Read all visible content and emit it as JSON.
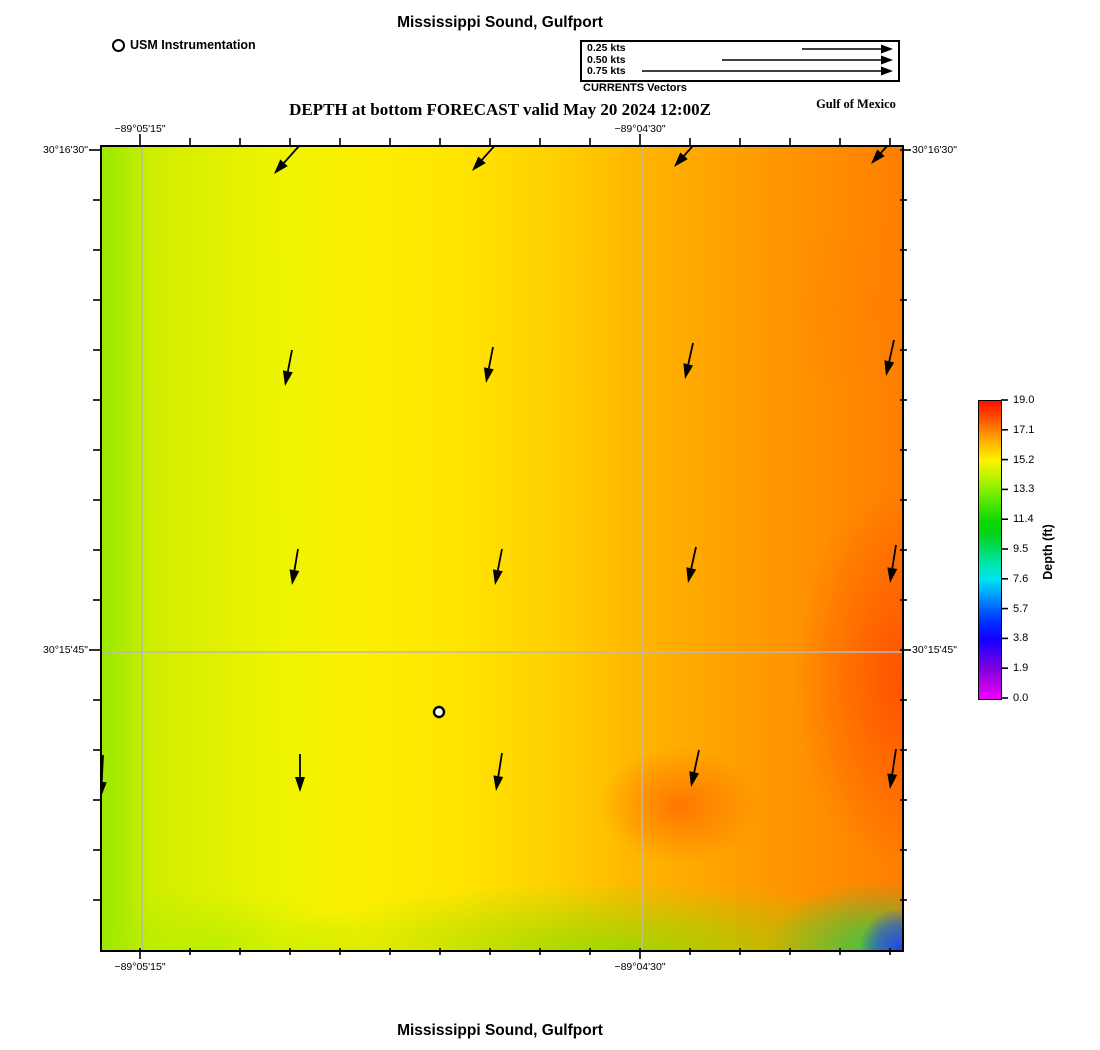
{
  "header": {
    "title": "Mississippi Sound, Gulfport",
    "instrumentation_label": "USM Instrumentation",
    "vector_legend": {
      "entries": [
        {
          "label": "0.25 kts",
          "x1": 220,
          "y": 7
        },
        {
          "label": "0.50 kts",
          "x1": 140,
          "y": 18
        },
        {
          "label": "0.75 kts",
          "x1": 60,
          "y": 29
        }
      ],
      "tip_x": 311,
      "caption": "CURRENTS Vectors"
    },
    "subtitle": "DEPTH at bottom FORECAST valid May 20 2024 12:00Z",
    "region_label": "Gulf of Mexico"
  },
  "map": {
    "axis": {
      "top": [
        {
          "text": "−89°05'15\"",
          "x": 140
        },
        {
          "text": "−89°04'30\"",
          "x": 640
        }
      ],
      "bottom": [
        {
          "text": "−89°05'15\"",
          "x": 140
        },
        {
          "text": "−89°04'30\"",
          "x": 640
        }
      ],
      "left": [
        {
          "text": "30°16'30\"",
          "y": 150
        },
        {
          "text": "30°15'45\"",
          "y": 650
        }
      ],
      "right": [
        {
          "text": "30°16'30\"",
          "y": 150
        },
        {
          "text": "30°15'45\"",
          "y": 650
        }
      ]
    },
    "gridlines": {
      "vertical_x": [
        40,
        540
      ],
      "horizontal_y": [
        505
      ]
    },
    "station_marker": {
      "x": 337,
      "y": 565
    },
    "vectors": [
      {
        "x1": 206,
        "y1": -11,
        "x2": 172,
        "y2": 27
      },
      {
        "x1": 404,
        "y1": -14,
        "x2": 370,
        "y2": 24
      },
      {
        "x1": 606,
        "y1": -18,
        "x2": 572,
        "y2": 20
      },
      {
        "x1": 803,
        "y1": -21,
        "x2": 769,
        "y2": 17
      },
      {
        "x1": 190,
        "y1": 203,
        "x2": 183,
        "y2": 239
      },
      {
        "x1": 391,
        "y1": 200,
        "x2": 384,
        "y2": 236
      },
      {
        "x1": 591,
        "y1": 196,
        "x2": 583,
        "y2": 232
      },
      {
        "x1": 792,
        "y1": 193,
        "x2": 784,
        "y2": 229
      },
      {
        "x1": 196,
        "y1": 402,
        "x2": 190,
        "y2": 438
      },
      {
        "x1": 400,
        "y1": 402,
        "x2": 393,
        "y2": 438
      },
      {
        "x1": 594,
        "y1": 400,
        "x2": 586,
        "y2": 436
      },
      {
        "x1": 794,
        "y1": 398,
        "x2": 788,
        "y2": 436
      },
      {
        "x1": 198,
        "y1": 607,
        "x2": 198,
        "y2": 645
      },
      {
        "x1": 400,
        "y1": 606,
        "x2": 394,
        "y2": 644
      },
      {
        "x1": 597,
        "y1": 603,
        "x2": 589,
        "y2": 640
      },
      {
        "x1": 794,
        "y1": 602,
        "x2": 788,
        "y2": 642
      },
      {
        "x1": 1,
        "y1": 608,
        "x2": -1,
        "y2": 650
      }
    ]
  },
  "colorbar": {
    "title": "Depth (ft)",
    "ticks": [
      "19.0",
      "17.1",
      "15.2",
      "13.3",
      "11.4",
      "9.5",
      "7.6",
      "5.7",
      "3.8",
      "1.9",
      "0.0"
    ]
  },
  "footer": {
    "title": "Mississippi Sound, Gulfport"
  },
  "colors": {
    "vector": "#000000",
    "gridline": "#b8b8b8",
    "map_border": "#000000"
  },
  "chart_data": {
    "type": "heatmap",
    "title": "Mississippi Sound, Gulfport",
    "subtitle": "DEPTH at bottom FORECAST valid May 20 2024 12:00Z",
    "variable": "Depth (ft)",
    "colorbar": {
      "min": 0.0,
      "max": 19.0,
      "ticks": [
        19.0,
        17.1,
        15.2,
        13.3,
        11.4,
        9.5,
        7.6,
        5.7,
        3.8,
        1.9,
        0.0
      ],
      "colormap": "rainbow: magenta(0) → blue → cyan → green → yellow → orange → red(19)"
    },
    "x_axis": {
      "type": "longitude",
      "tick_labels": [
        "−89°05'15\"",
        "−89°04'30\""
      ],
      "grid": true
    },
    "y_axis": {
      "type": "latitude",
      "tick_labels": [
        "30°16'30\"",
        "30°15'45\""
      ],
      "grid": true
    },
    "depth_grid_ft_estimated": {
      "note": "coarse 5×5 estimate from colors, rows north→south, cols west→east",
      "values": [
        [
          14.3,
          15.0,
          15.8,
          16.8,
          17.3
        ],
        [
          14.5,
          15.2,
          16.2,
          17.3,
          17.8
        ],
        [
          14.6,
          15.3,
          16.5,
          17.6,
          18.6
        ],
        [
          14.2,
          15.4,
          16.9,
          17.9,
          18.3
        ],
        [
          13.8,
          14.9,
          14.2,
          12.3,
          4.5
        ]
      ]
    },
    "current_vectors": {
      "legend_scale_kts": [
        0.25,
        0.5,
        0.75
      ],
      "field": "4×4 grid of arrows plus west-edge arrow; northern row ≈0.5 kts toward SW, southern rows ≈0.3–0.4 kts toward S/SSW"
    },
    "station": {
      "name": "USM Instrumentation",
      "marker": "open circle",
      "location": "center-south of domain"
    }
  }
}
